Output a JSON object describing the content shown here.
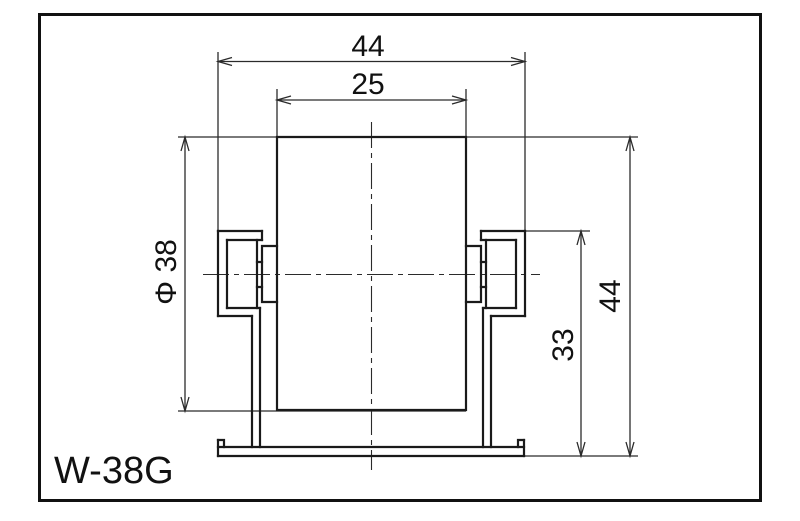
{
  "drawing": {
    "part_label": "W-38G",
    "dimensions": {
      "frame_outer_width": "44",
      "wheel_width": "25",
      "wheel_diameter": "Φ 38",
      "frame_height": "33",
      "overall_height": "44"
    },
    "colors": {
      "outline_line": "#1a1a1a",
      "thin_line": "#2b2b2b",
      "background": "#ffffff"
    }
  }
}
